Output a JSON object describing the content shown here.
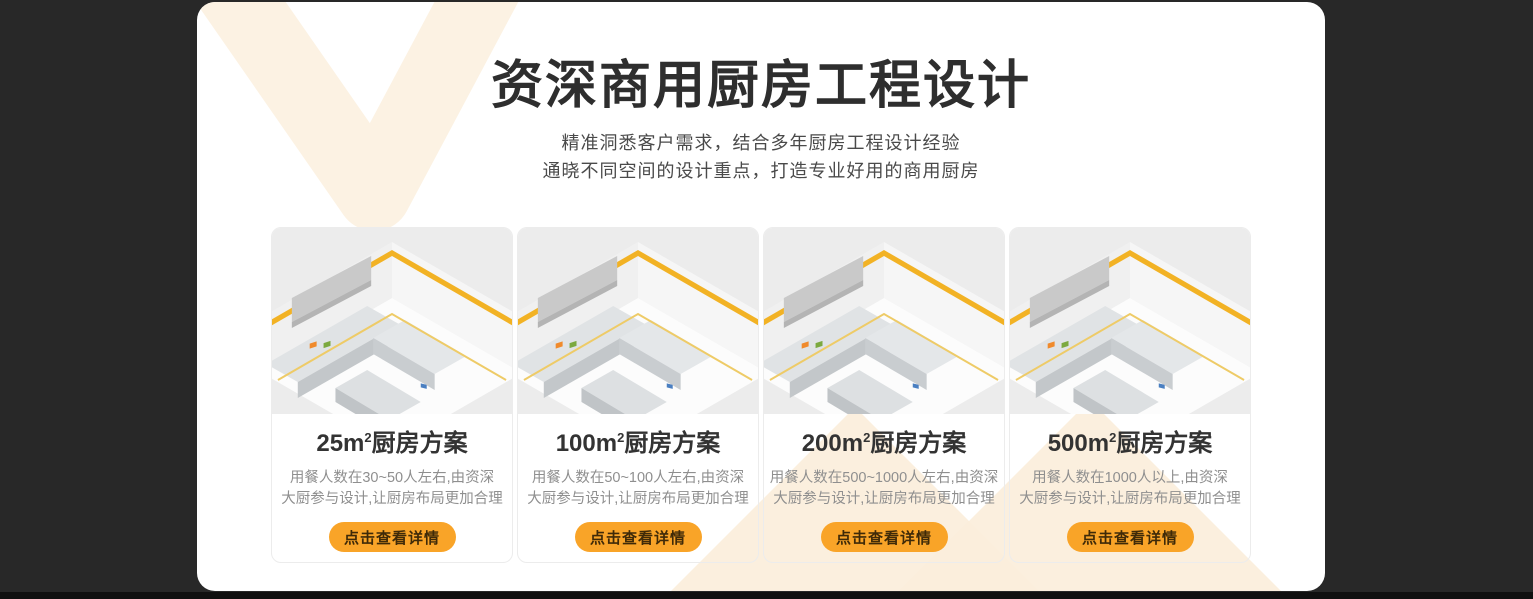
{
  "page": {
    "background_color": "#282828",
    "footer_bar_color": "#101010",
    "panel_color": "#ffffff"
  },
  "hero": {
    "title": "资深商用厨房工程设计",
    "subtitle_line1": "精准洞悉客户需求，结合多年厨房工程设计经验",
    "subtitle_line2": "通晓不同空间的设计重点，打造专业好用的商用厨房"
  },
  "colors": {
    "accent_orange": "#F9A428",
    "decor_cream": "#FBEEDB",
    "decor_cream_top": "#FCF2E3",
    "stripe_yellow": "#F2B224",
    "button_text": "#3f2a08"
  },
  "cards": [
    {
      "area": "25m",
      "area_sup": "2",
      "title_suffix": "厨房方案",
      "description_line1": "用餐人数在30~50人左右,由资深",
      "description_line2": "大厨参与设计,让厨房布局更加合理",
      "button_label": "点击查看详情"
    },
    {
      "area": "100m",
      "area_sup": "2",
      "title_suffix": "厨房方案",
      "description_line1": "用餐人数在50~100人左右,由资深",
      "description_line2": "大厨参与设计,让厨房布局更加合理",
      "button_label": "点击查看详情"
    },
    {
      "area": "200m",
      "area_sup": "2",
      "title_suffix": "厨房方案",
      "description_line1": "用餐人数在500~1000人左右,由资深",
      "description_line2": "大厨参与设计,让厨房布局更加合理",
      "button_label": "点击查看详情"
    },
    {
      "area": "500m",
      "area_sup": "2",
      "title_suffix": "厨房方案",
      "description_line1": "用餐人数在1000人以上,由资深",
      "description_line2": "大厨参与设计,让厨房布局更加合理",
      "button_label": "点击查看详情"
    }
  ]
}
